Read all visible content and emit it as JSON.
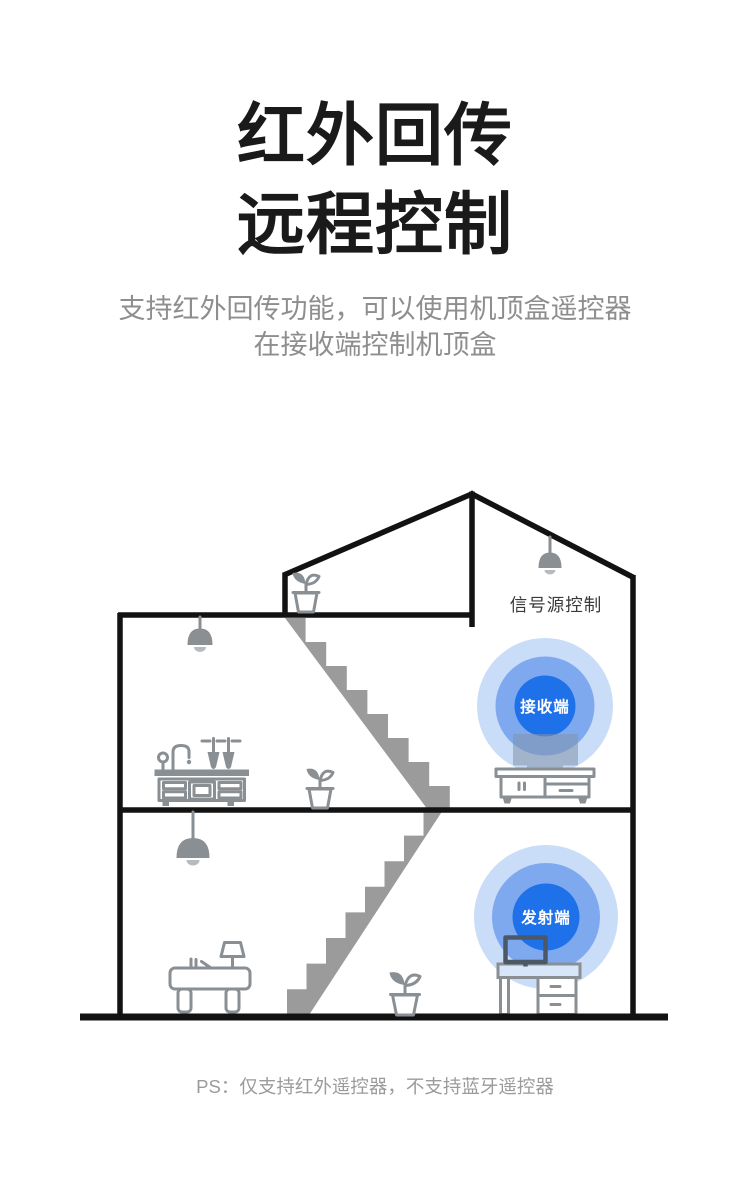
{
  "page": {
    "title_line1": "红外回传",
    "title_line2": "远程控制",
    "subtitle_line1": "支持红外回传功能，可以使用机顶盒遥控器",
    "subtitle_line2": "在接收端控制机顶盒",
    "footer_note": "PS：仅支持红外遥控器，不支持蓝牙遥控器"
  },
  "diagram": {
    "signal_source_label": "信号源控制",
    "receiver_label": "接收端",
    "transmitter_label": "发射端",
    "icons": {
      "roof_lamp": "pendant-lamp-icon",
      "upper_floor_lamp": "pendant-lamp-icon",
      "lower_floor_lamp": "pendant-lamp-icon",
      "ledge_plant": "potted-plant-icon",
      "upper_floor_plant": "potted-plant-icon",
      "lower_floor_plant": "potted-plant-icon",
      "kitchen_sink": "kitchen-sink-cabinet-icon",
      "upper_stairs": "stairs-icon",
      "lower_stairs": "stairs-icon",
      "tv": "tv-icon",
      "tv_stand": "tv-stand-icon",
      "reading_desk": "desk-with-lamp-icon",
      "monitor": "computer-monitor-icon",
      "computer_desk": "computer-desk-icon"
    }
  },
  "colors": {
    "background": "#ffffff",
    "title_text": "#1a1a1a",
    "subtitle_text": "#8e8e8e",
    "footer_text": "#9b9b9b",
    "label_text": "#3a3a3a",
    "outline_black": "#121212",
    "furniture_gray": "#8a8f94",
    "stairs_gray": "#9b9b9b",
    "lamp_bulb_gray": "#b6bbc0",
    "accent_blue": "#1f71e9",
    "ring_mid_blue": "#7fa9ef",
    "ring_outer_blue": "#c9dcf8",
    "ring_label_text": "#ffffff",
    "tv_silhouette": "#8094a8",
    "desk_surface_blue": "#d8e6f9",
    "monitor_stroke": "#4d5866"
  }
}
